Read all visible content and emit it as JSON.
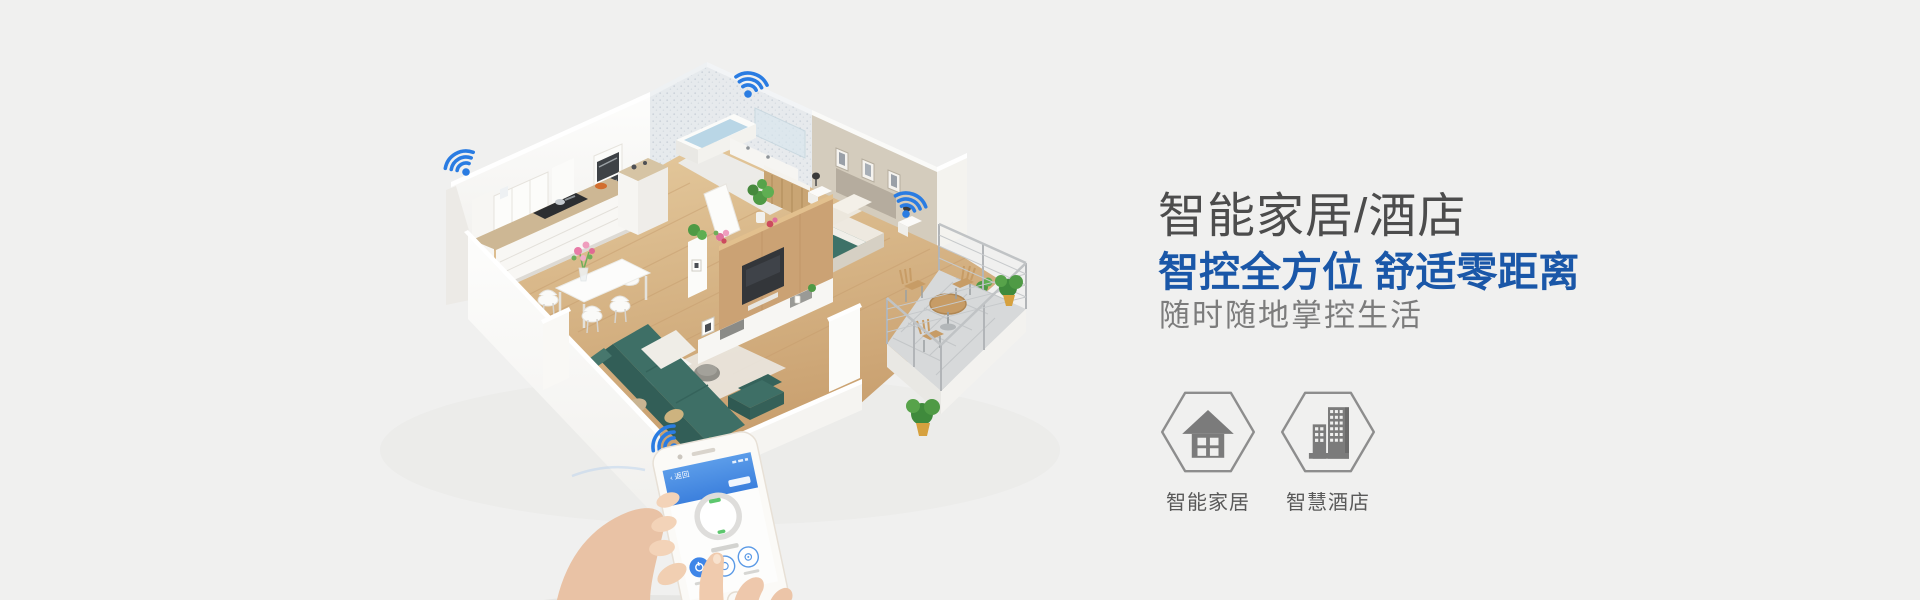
{
  "page": {
    "background": "#f0f0ef"
  },
  "hero": {
    "title": "智能家居/酒店",
    "headline": "智控全方位 舒适零距离",
    "tagline": "随时随地掌控生活",
    "colors": {
      "title": "#4c4c4c",
      "headline": "#1a57a8",
      "tagline": "#7c7c7c"
    }
  },
  "categories": [
    {
      "id": "smart-home",
      "label": "智能家居",
      "icon": "house-icon"
    },
    {
      "id": "smart-hotel",
      "label": "智慧酒店",
      "icon": "hotel-buildings-icon"
    }
  ],
  "illustration": {
    "description": "isometric cutaway smart apartment with four wifi hotspots and a hand holding a smart-control phone",
    "wifi_hotspots": 4,
    "wifi_color": "#2a7ce2",
    "phone": {
      "back_label": "‹ 返回",
      "header_color": "#4a90e2",
      "accent_green": "#5dc76e"
    }
  }
}
